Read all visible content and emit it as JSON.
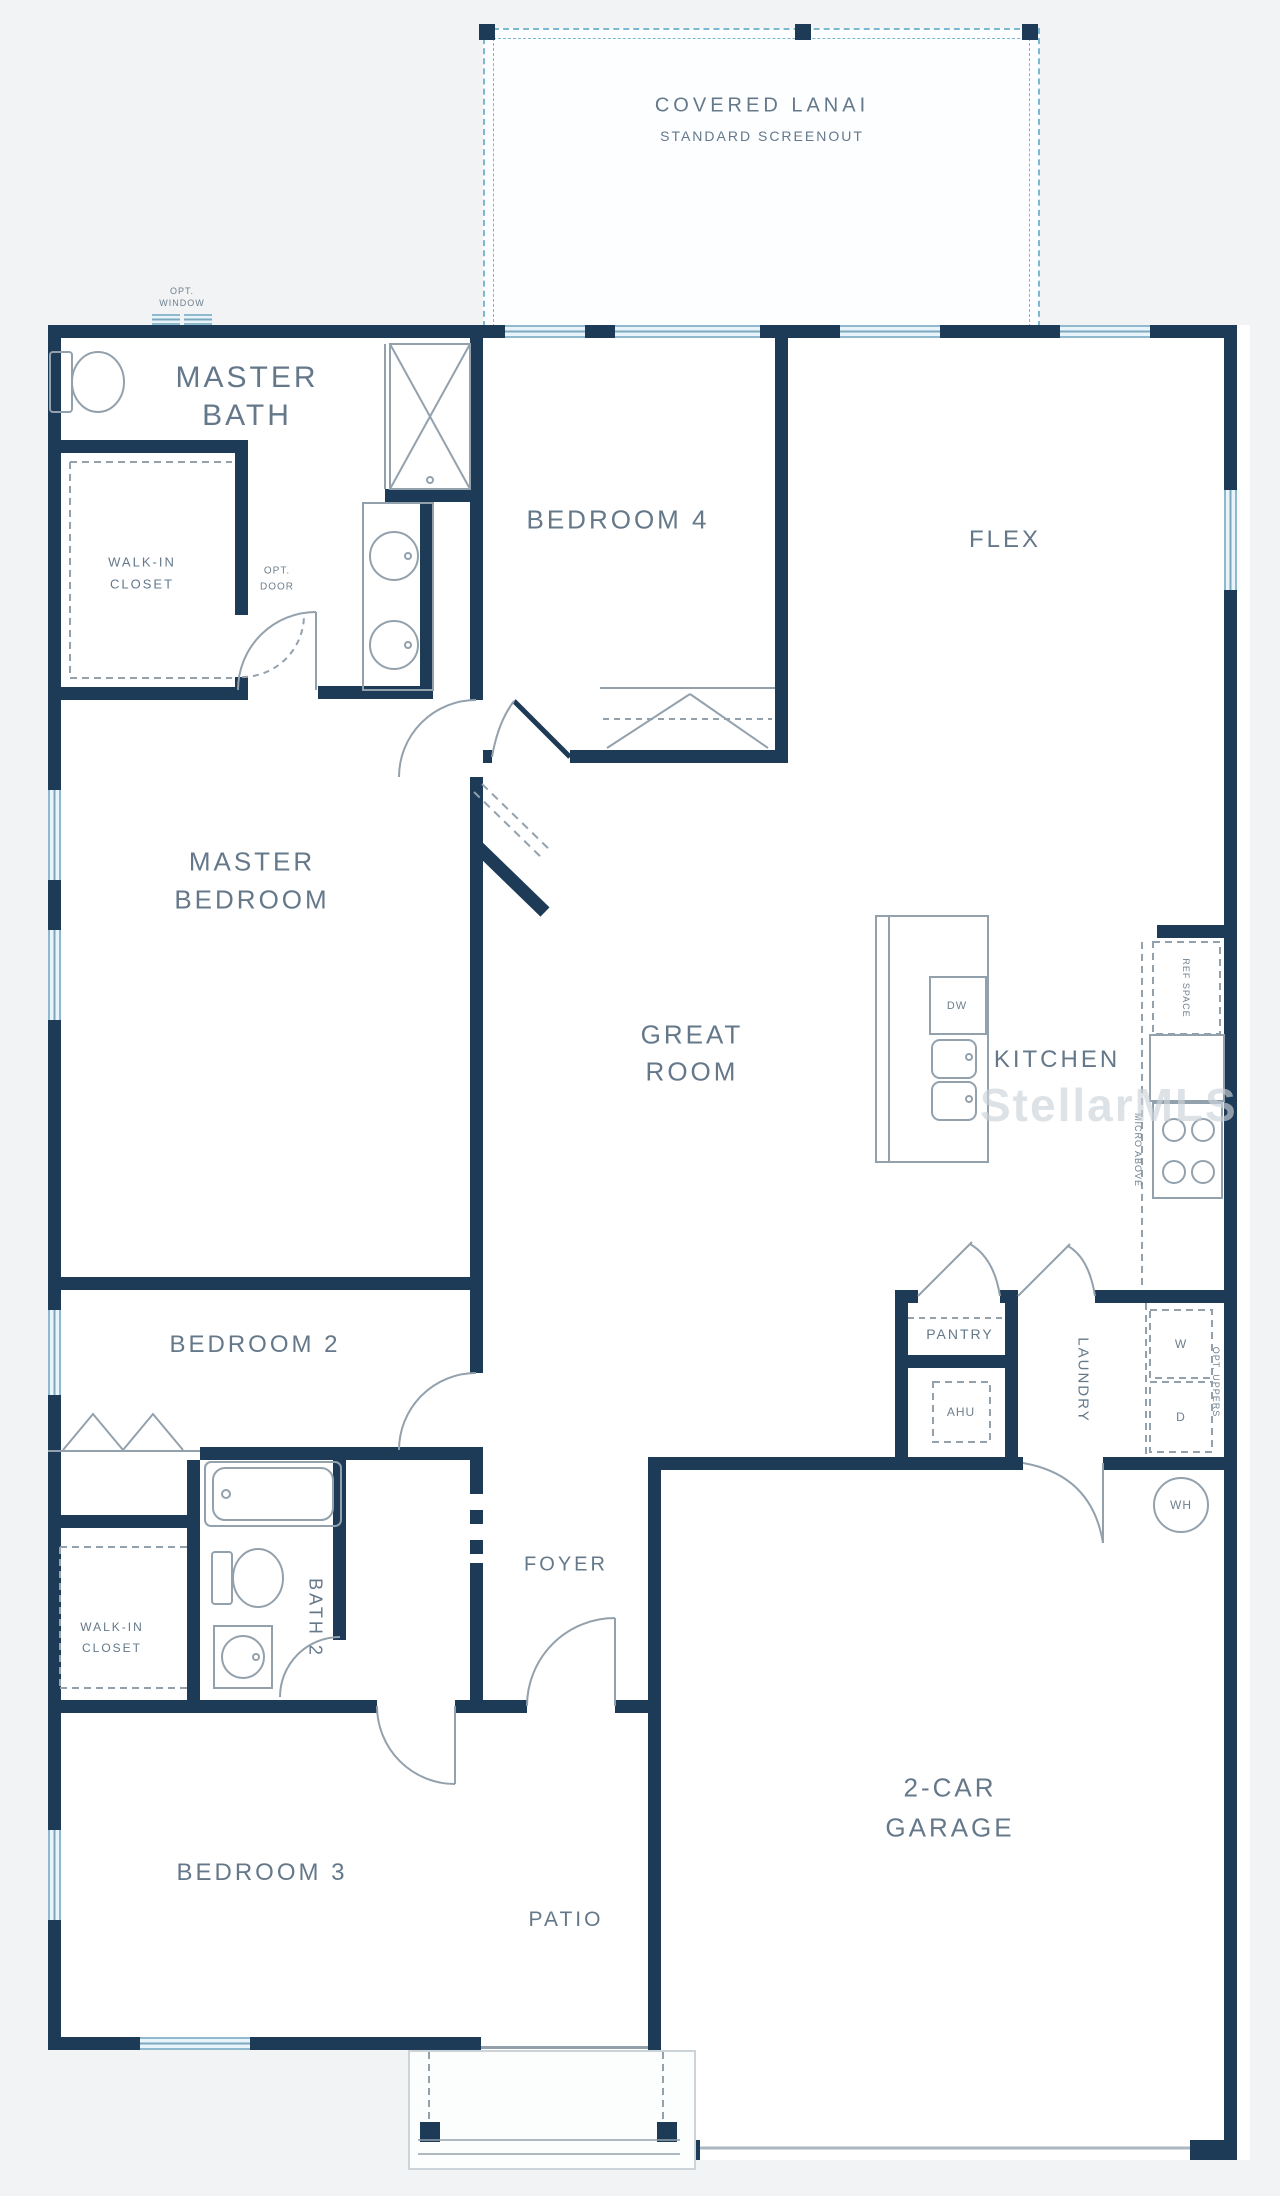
{
  "palette": {
    "wall": "#1d3a56",
    "bg": "#f2f3f4",
    "paper": "#ffffff",
    "fixture": "#93a1ad",
    "label": "#64788a",
    "lanai": "#7db8d2",
    "watermark": "#ccd3d9"
  },
  "watermark": {
    "text": "StellarMLS"
  },
  "lanai": {
    "line1": "COVERED LANAI",
    "line2": "STANDARD SCREENOUT"
  },
  "rooms": {
    "master_bath": {
      "line1": "MASTER",
      "line2": "BATH"
    },
    "master_bedroom": {
      "line1": "MASTER",
      "line2": "BEDROOM"
    },
    "bedroom4": {
      "label": "BEDROOM 4"
    },
    "flex": {
      "label": "FLEX"
    },
    "great_room": {
      "line1": "GREAT",
      "line2": "ROOM"
    },
    "kitchen": {
      "label": "KITCHEN"
    },
    "bedroom2": {
      "label": "BEDROOM 2"
    },
    "bedroom3": {
      "label": "BEDROOM 3"
    },
    "bath2": {
      "label": "BATH 2"
    },
    "foyer": {
      "label": "FOYER"
    },
    "patio": {
      "label": "PATIO"
    },
    "garage": {
      "line1": "2-CAR",
      "line2": "GARAGE"
    },
    "pantry": {
      "label": "PANTRY"
    },
    "laundry": {
      "label": "LAUNDRY"
    },
    "walkin_master": {
      "line1": "WALK-IN",
      "line2": "CLOSET"
    },
    "walkin_bed3": {
      "line1": "WALK-IN",
      "line2": "CLOSET"
    }
  },
  "annotations": {
    "opt_window_1": "OPT.",
    "opt_window_2": "WINDOW",
    "opt_door_1": "OPT.",
    "opt_door_2": "DOOR",
    "ref_space": "REF SPACE",
    "micro_above": "MICRO ABOVE",
    "opt_uppers": "OPT. UPPERS",
    "dw": "DW",
    "ahu": "AHU",
    "washer": "W",
    "dryer": "D",
    "water_heater": "WH"
  }
}
